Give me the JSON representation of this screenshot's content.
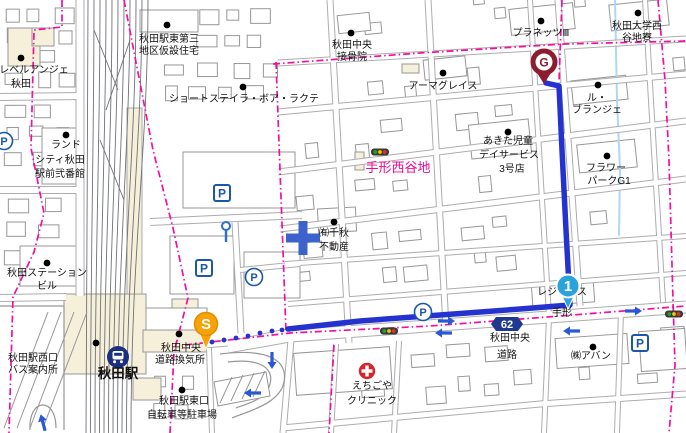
{
  "map_title": "route-map-akita-station",
  "colors": {
    "bg": "#ffffff",
    "road_casing": "#adadb0",
    "building_stroke": "#97979a",
    "building_fill": "#ffffff",
    "beige": "#f6efda",
    "rail": "#6f7174",
    "boundary_pink": "#f30fa0",
    "route_blue": "#2433cf",
    "water_blue": "#aed8f2",
    "parking_blue": "#1b57a8",
    "badge_blue": "#20398f",
    "start_orange": "#f7a306",
    "goal_maroon": "#8d1d2e",
    "waypoint_azure": "#2aa3dd",
    "clinic_red": "#d6252b",
    "arrow_blue": "#2a57d6",
    "area_label_pink": "#f00996",
    "label_black": "#111111"
  },
  "area_label": {
    "text": "手形西谷地",
    "x": 398,
    "y": 172
  },
  "road_badge": {
    "text": "62",
    "x": 507,
    "y": 324
  },
  "station": {
    "name": "秋田駅",
    "x": 118,
    "y": 378,
    "icon_x": 118,
    "icon_y": 357
  },
  "markers": {
    "start": {
      "letter": "S",
      "x": 206,
      "y": 324,
      "tip_y": 349
    },
    "goal": {
      "letter": "G",
      "x": 544,
      "y": 62,
      "tip_y": 84
    },
    "waypoint": {
      "letter": "1",
      "x": 568,
      "y": 286,
      "tip_y": 309
    }
  },
  "route": {
    "dots": [
      [
        212,
        342
      ],
      [
        224,
        340
      ],
      [
        236,
        338
      ],
      [
        248,
        336
      ],
      [
        260,
        333
      ],
      [
        272,
        331
      ],
      [
        282,
        330
      ]
    ],
    "line": [
      [
        288,
        329
      ],
      [
        360,
        321
      ],
      [
        440,
        315
      ],
      [
        520,
        309
      ],
      [
        570,
        305
      ],
      [
        566,
        230
      ],
      [
        562,
        150
      ],
      [
        559,
        86
      ],
      [
        546,
        83
      ]
    ]
  },
  "labels": [
    {
      "name": "akita-eki-higashi-daisan",
      "lines": [
        [
          "秋田駅東第三",
          169,
          42
        ],
        [
          "地区仮設住宅",
          169,
          54
        ]
      ],
      "dot": [
        167,
        25
      ]
    },
    {
      "name": "level-ange-akita",
      "lines": [
        [
          "レベルアンジェ",
          34,
          73
        ],
        [
          "秋田",
          21,
          87
        ]
      ],
      "dot": [
        21,
        58
      ]
    },
    {
      "name": "akita-chuo-sekkotsuin",
      "lines": [
        [
          "秋田中央",
          352,
          48
        ],
        [
          "接骨院",
          352,
          60
        ]
      ],
      "dot": [
        351,
        33
      ]
    },
    {
      "name": "planets-iii",
      "lines": [
        [
          "プラネッツⅢ",
          541,
          36
        ]
      ],
      "dot": [
        541,
        21
      ]
    },
    {
      "name": "akita-univ-nishiyachi-ryo",
      "lines": [
        [
          "秋田大学西",
          637,
          29
        ],
        [
          "谷地寮",
          637,
          41
        ]
      ],
      "dot": [
        638,
        13
      ]
    },
    {
      "name": "armagrace",
      "lines": [
        [
          "アーマグレイス",
          443,
          89
        ]
      ],
      "dot": [
        443,
        73
      ]
    },
    {
      "name": "le-boulanger",
      "lines": [
        [
          "ル・",
          597,
          101
        ],
        [
          "ブランジェ",
          597,
          113
        ]
      ],
      "dot": [
        598,
        85
      ]
    },
    {
      "name": "short-stay-la-boa-lacte",
      "lines": [
        [
          "ショートステイラ・ボア・ラクテ",
          244,
          102
        ]
      ],
      "dot": [
        243,
        87
      ]
    },
    {
      "name": "land-city-akita",
      "lines": [
        [
          "ランド",
          66,
          148
        ],
        [
          "シティ秋田",
          60,
          163
        ],
        [
          "駅前弐番館",
          60,
          177
        ]
      ],
      "dot": [
        66,
        135
      ]
    },
    {
      "name": "akita-jido-day-service",
      "lines": [
        [
          "あきた児童",
          508,
          144
        ],
        [
          "デイサービス",
          509,
          158
        ],
        [
          "3号店",
          512,
          172
        ]
      ],
      "dot": [
        508,
        132
      ]
    },
    {
      "name": "flower-park-g1",
      "lines": [
        [
          "フラワー",
          606,
          171
        ],
        [
          "パークG1",
          609,
          184
        ]
      ],
      "dot": [
        607,
        156
      ]
    },
    {
      "name": "senshu-fudosan",
      "lines": [
        [
          "㈲千秋",
          334,
          236
        ],
        [
          "不動産",
          334,
          250
        ]
      ],
      "dot": [
        334,
        222
      ]
    },
    {
      "name": "akita-station-building",
      "lines": [
        [
          "秋田ステーション",
          47,
          276
        ],
        [
          "ビル",
          47,
          289
        ]
      ],
      "dot": [
        47,
        263
      ]
    },
    {
      "name": "residence-tegata",
      "lines": [
        [
          "レジデンス",
          562,
          295
        ],
        [
          "手形",
          562,
          316
        ]
      ]
    },
    {
      "name": "akita-chuo-doro-kankisho",
      "lines": [
        [
          "秋田中央",
          181,
          351
        ],
        [
          "道路換気所",
          180,
          363
        ]
      ],
      "dot": [
        179,
        334
      ]
    },
    {
      "name": "akita-eki-nishiguchi-bus",
      "lines": [
        [
          "秋田駅西口",
          33,
          361
        ],
        [
          "バス案内所",
          33,
          373
        ]
      ],
      "dot": [
        96,
        343
      ]
    },
    {
      "name": "akita-chuo-doro",
      "lines": [
        [
          "秋田中央",
          510,
          341
        ],
        [
          "道路",
          507,
          358
        ]
      ]
    },
    {
      "name": "avan",
      "lines": [
        [
          "㈱アバン",
          591,
          359
        ]
      ],
      "dot": [
        593,
        347
      ]
    },
    {
      "name": "echigoya-clinic",
      "lines": [
        [
          "えちごや",
          372,
          389
        ],
        [
          "クリニック",
          372,
          404
        ]
      ]
    },
    {
      "name": "akita-eki-higashiguchi-parking",
      "lines": [
        [
          "秋田駅東口",
          184,
          404
        ],
        [
          "自転車等駐車場",
          182,
          418
        ]
      ],
      "dot": [
        182,
        390
      ]
    }
  ],
  "parking": {
    "letter": "P",
    "squares": [
      [
        222,
        193
      ],
      [
        204,
        268
      ],
      [
        640,
        343
      ]
    ],
    "circles": [
      [
        4,
        141
      ],
      [
        254,
        277
      ],
      [
        423,
        312
      ]
    ]
  },
  "traffic_lights": [
    [
      380,
      152
    ],
    [
      389,
      331
    ],
    [
      674,
      314
    ]
  ],
  "oneway_arrows": [
    [
      446,
      321,
      0
    ],
    [
      633,
      311,
      0
    ],
    [
      572,
      331,
      180
    ],
    [
      444,
      333,
      180
    ],
    [
      253,
      393,
      180
    ],
    [
      272,
      360,
      90
    ],
    [
      43,
      423,
      -105
    ]
  ],
  "symbols": {
    "hospital_cross": [
      303,
      238
    ],
    "clinic_cross": [
      367,
      371
    ],
    "gate": [
      226,
      228
    ]
  }
}
